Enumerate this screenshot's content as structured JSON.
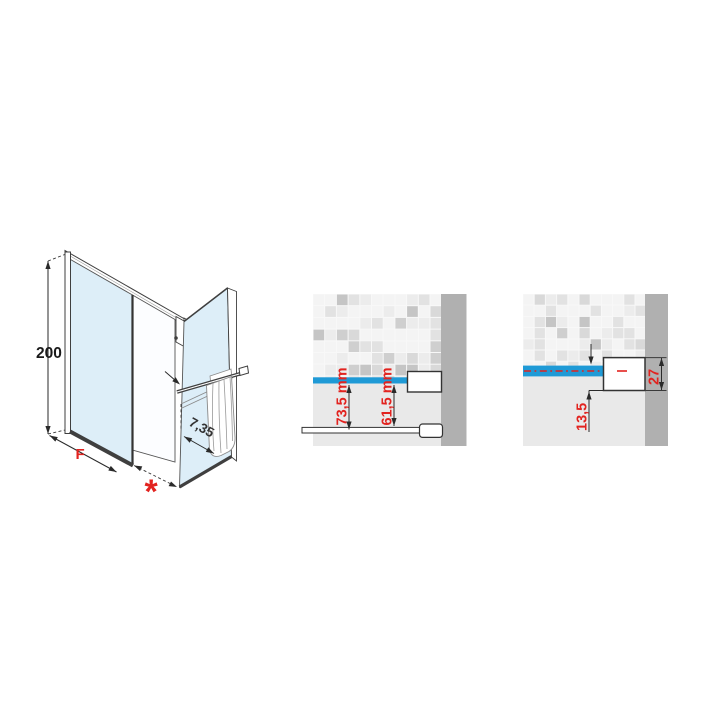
{
  "colors": {
    "glass_blue_line": "#1F9AD6",
    "dimension_red": "#E2231F",
    "drawing_line": "#3A3A3A",
    "glass_fill": "#DDEEF8",
    "tile_wall_dark_band": "#B0B0B0",
    "wall_lower_plain": "#E9E9E9"
  },
  "isometric_view": {
    "height_dim_label": "200",
    "fixed_panel_dim_label": "F",
    "extension_dim_label": "*",
    "profile_adjustment_label": "7,35"
  },
  "wall_section_detail_1": {
    "wall_to_glass_label": "73,5 mm",
    "wall_to_panel_label": "61,5 mm"
  },
  "wall_section_detail_2": {
    "glass_recess_label": "13,5",
    "profile_depth_label": "27"
  }
}
